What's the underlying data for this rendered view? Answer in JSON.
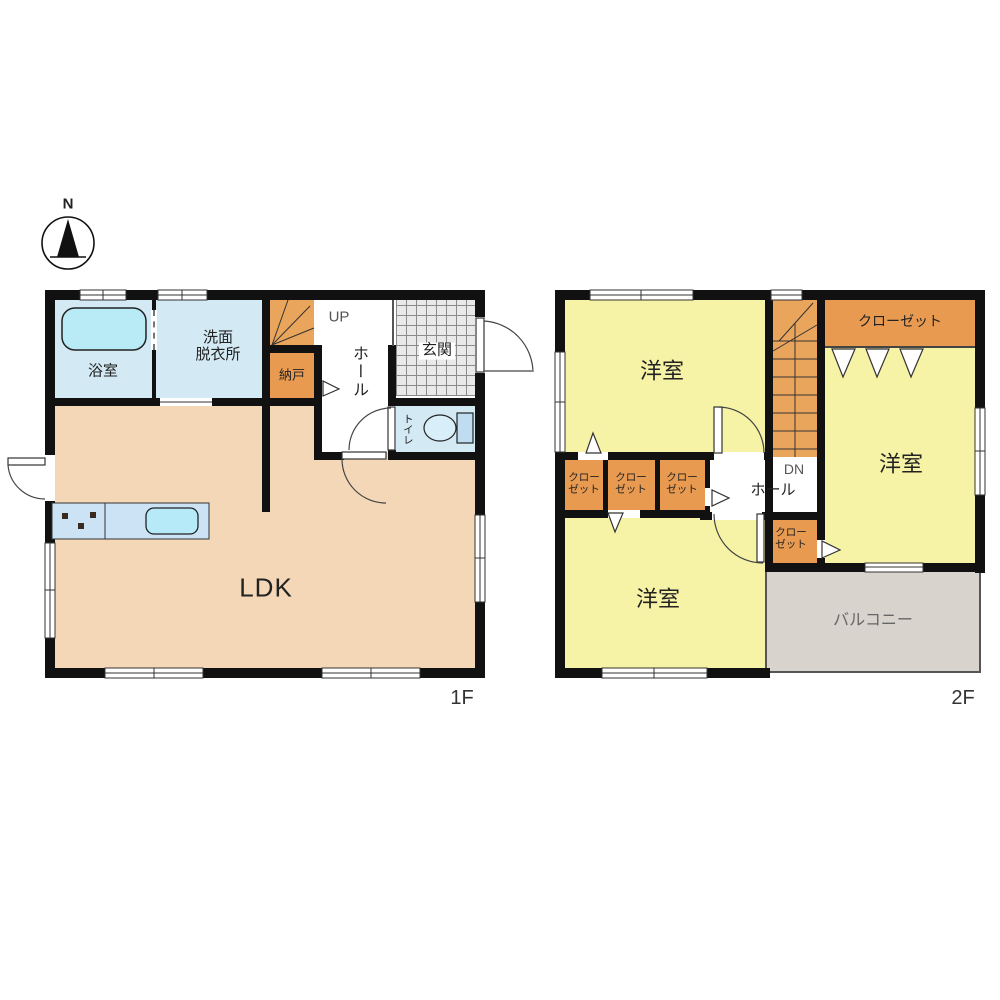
{
  "compass": {
    "north": "N"
  },
  "floor1": {
    "name": "1F",
    "rooms": {
      "bathroom": "浴室",
      "washroom_line1": "洗面",
      "washroom_line2": "脱衣所",
      "storage": "納戸",
      "stairs": "UP",
      "hall": "ホール",
      "entrance": "玄関",
      "toilet": "トイレ",
      "living": "LDK"
    }
  },
  "floor2": {
    "name": "2F",
    "rooms": {
      "bedroom_a": "洋室",
      "bedroom_b": "洋室",
      "bedroom_c": "洋室",
      "closet_main": "クローゼット",
      "closet_small_line1": "クロー",
      "closet_small_line2": "ゼット",
      "stairs": "DN",
      "hall": "ホール",
      "balcony": "バルコニー"
    }
  },
  "colors": {
    "wall": "#111111",
    "water_rooms": "#d3e9f4",
    "bathtub": "#b9ebf7",
    "closet_orange": "#e89a50",
    "stairs_orange": "#eaa55c",
    "bedroom_yellow": "#f6f3a6",
    "ldk_peach": "#f4d7b7",
    "balcony_gray": "#d9d3cd",
    "entrance_tile": "#e9e9e9",
    "kitchen_counter": "#cbe3f5",
    "sink": "#b7eaf8"
  }
}
